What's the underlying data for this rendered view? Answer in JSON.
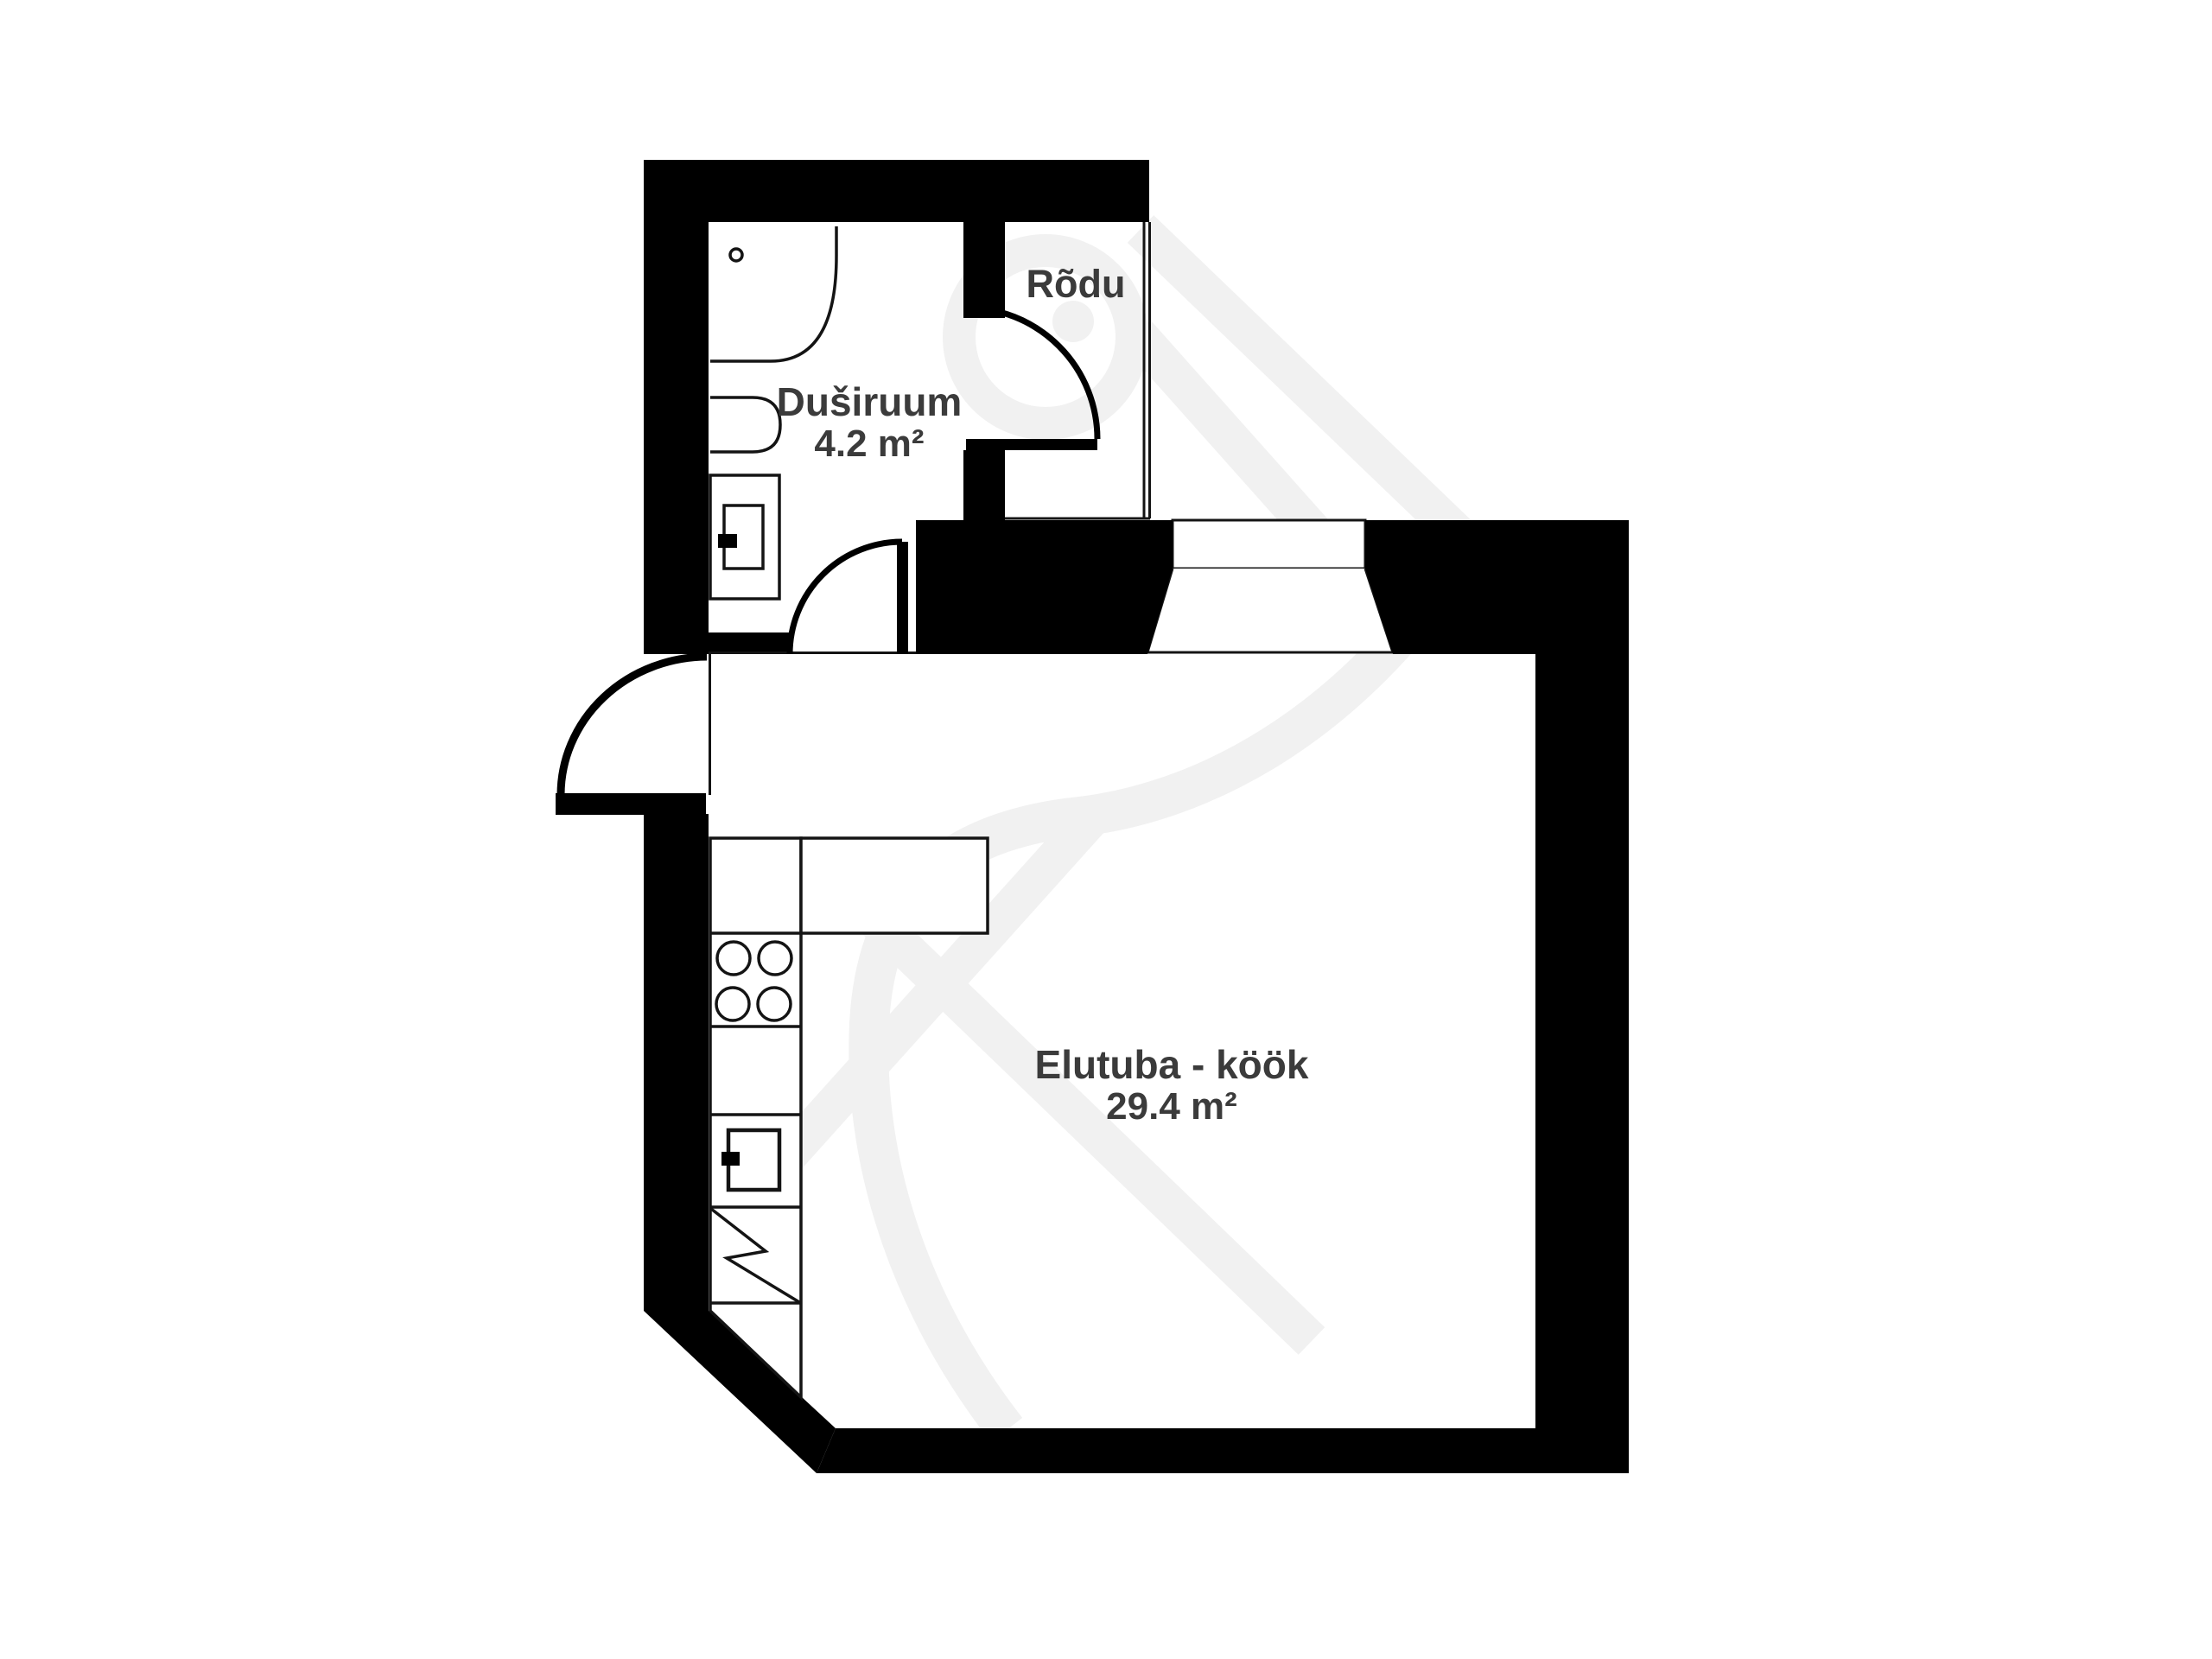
{
  "page": {
    "type": "floor-plan",
    "background": "#ffffff"
  },
  "palette": {
    "wall": "#000000",
    "fixture_line": "#141414",
    "text": "#3b3b3b",
    "watermark": "#f1f1f1"
  },
  "rooms": [
    {
      "id": "dushiruum",
      "name": "Duširuum",
      "area": "4.2 m²"
    },
    {
      "id": "rodu",
      "name": "Rõdu",
      "area": ""
    },
    {
      "id": "elutuba-kook",
      "name": "Elutuba - köök",
      "area": "29.4 m²"
    }
  ],
  "fixtures": [
    {
      "id": "shower-corner"
    },
    {
      "id": "shower-drain"
    },
    {
      "id": "bathtub"
    },
    {
      "id": "washing-machine"
    },
    {
      "id": "shower-door"
    },
    {
      "id": "balcony-door"
    },
    {
      "id": "entrance-door"
    },
    {
      "id": "window"
    },
    {
      "id": "balcony-glass-wall"
    },
    {
      "id": "kitchen-counter"
    },
    {
      "id": "stove-burners"
    },
    {
      "id": "kitchen-sink"
    },
    {
      "id": "dishwasher"
    }
  ]
}
